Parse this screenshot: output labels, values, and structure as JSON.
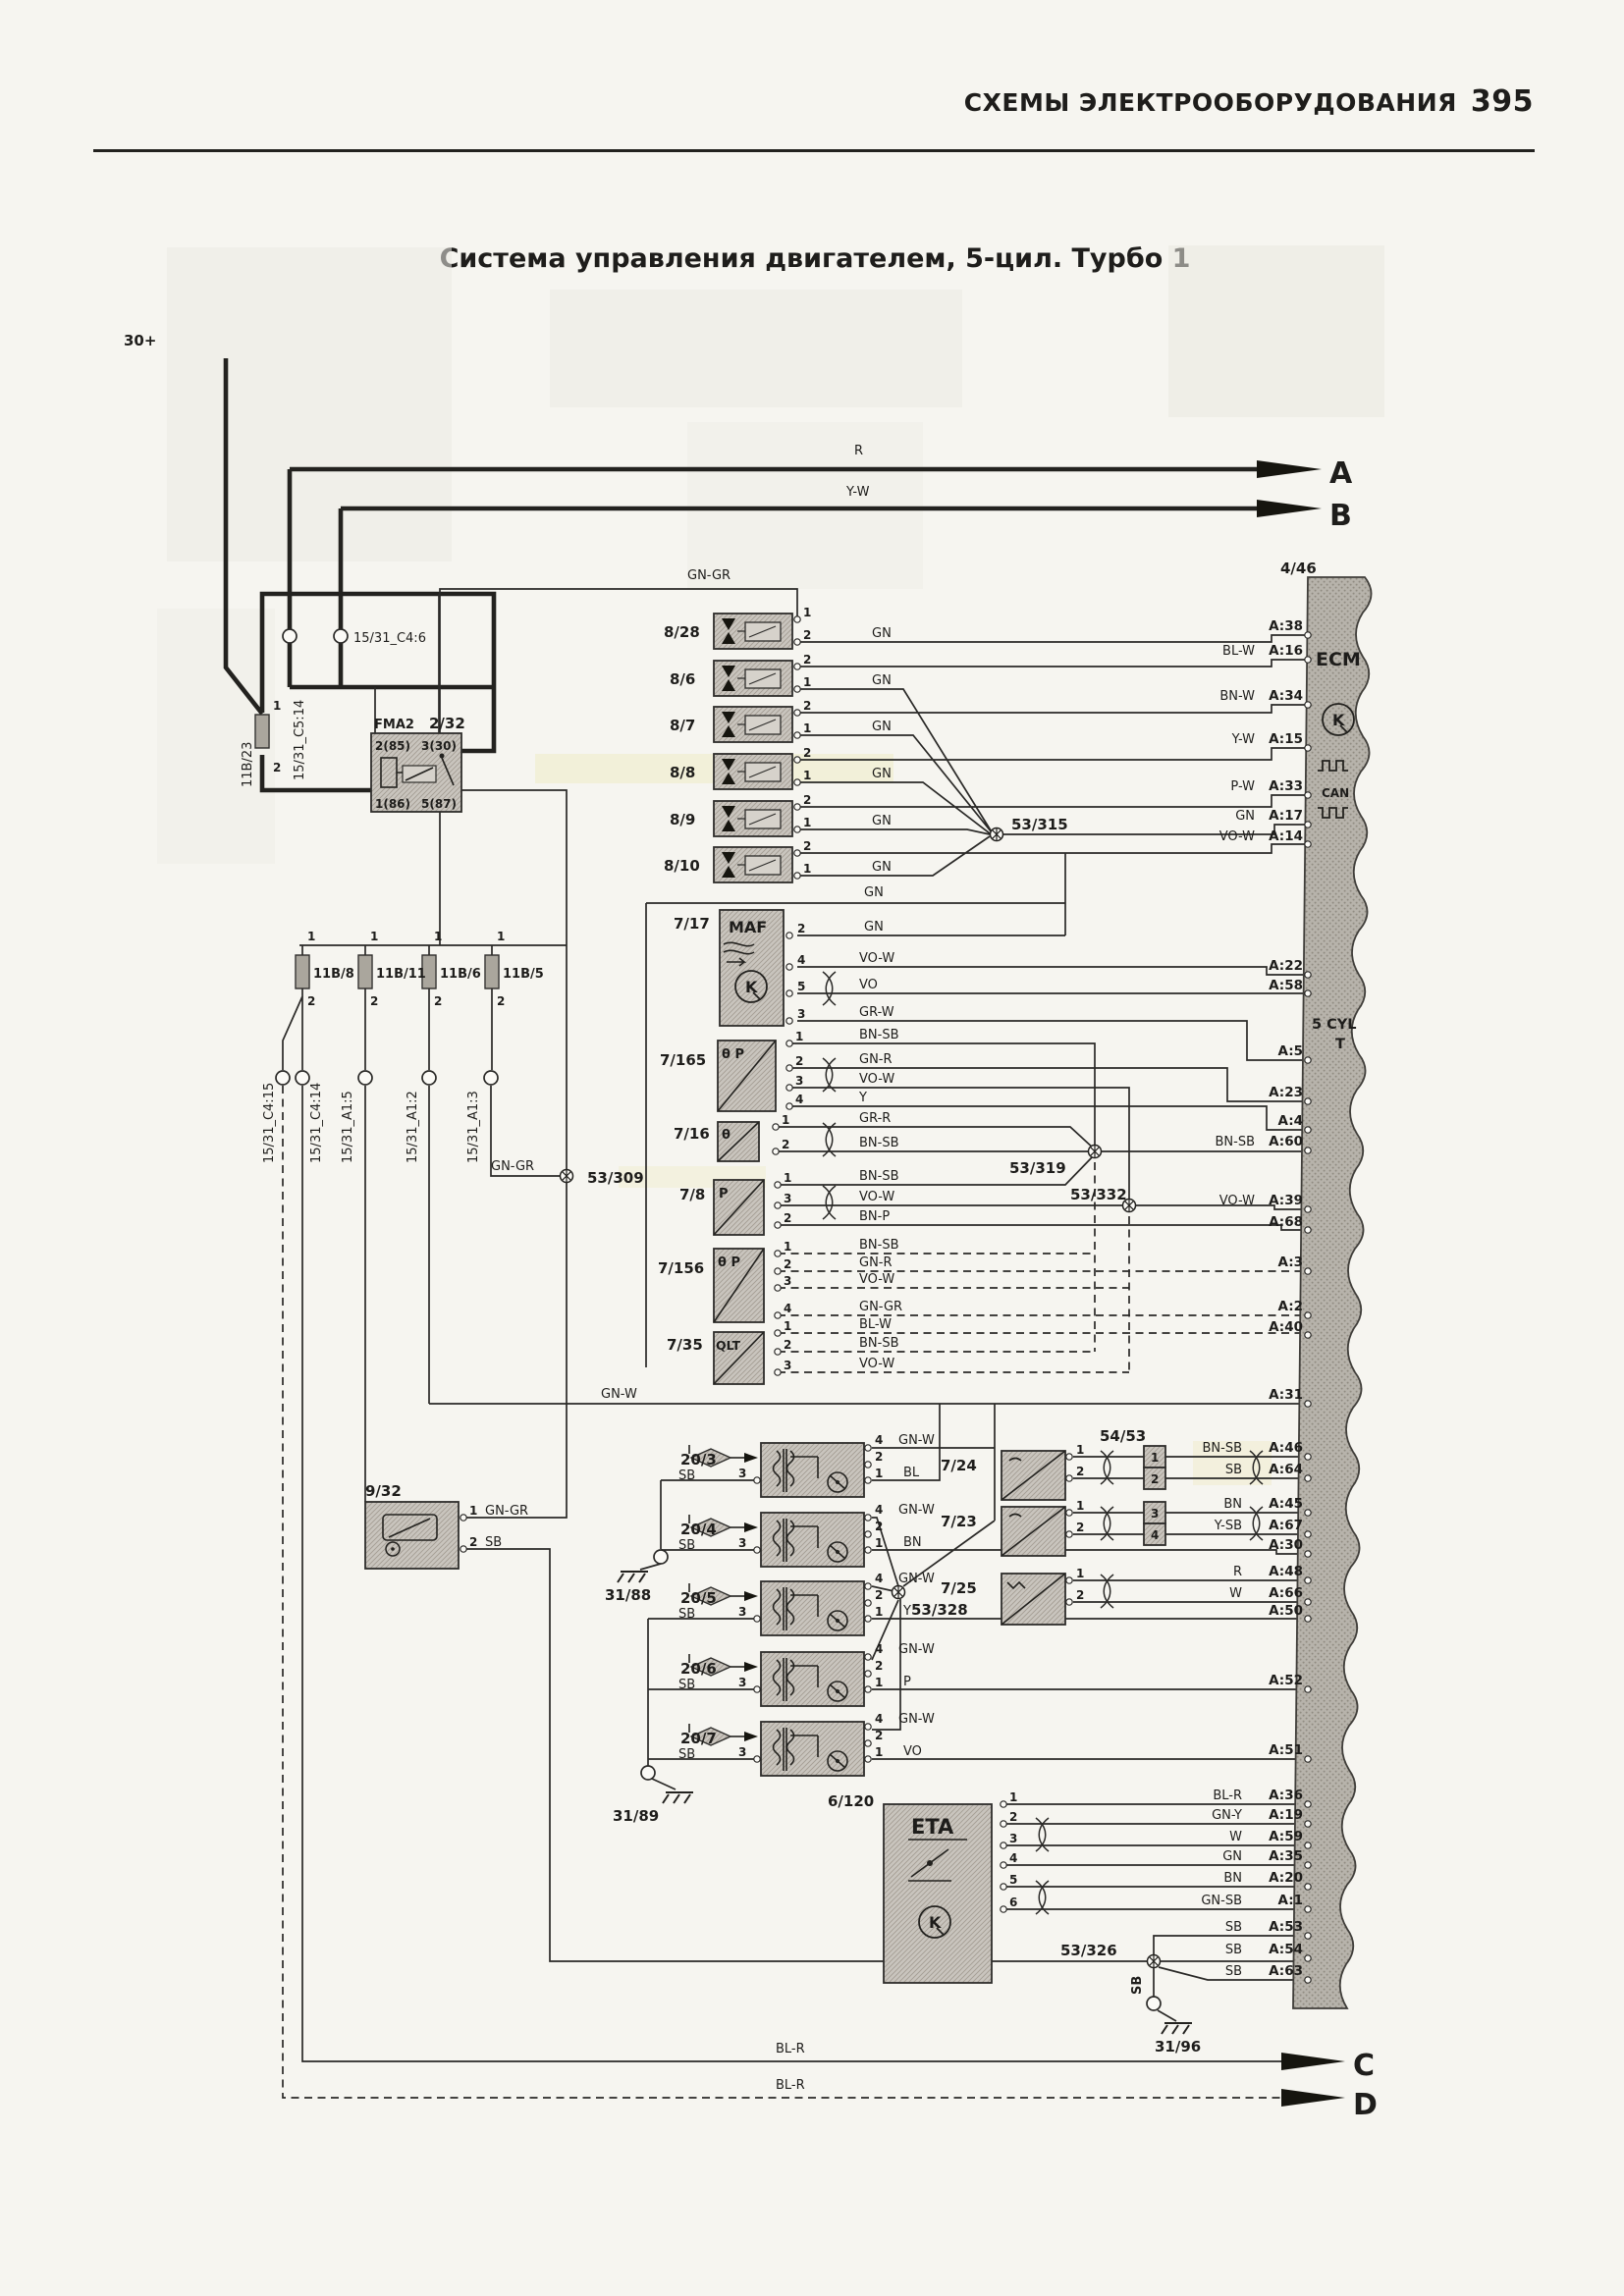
{
  "page": {
    "header": "СХЕМЫ ЭЛЕКТРООБОРУДОВАНИЯ",
    "page_number": "395",
    "title": "Система управления двигателем, 5-цил. Турбо 1"
  },
  "power": {
    "label": "30+"
  },
  "arrows": {
    "a": "A",
    "b": "B",
    "c": "C",
    "d": "D"
  },
  "top_wires": {
    "a": "R",
    "b": "Y-W"
  },
  "bottom_wires": {
    "c": "BL-R",
    "d": "BL-R"
  },
  "relay": {
    "name": "FMA2",
    "id": "2/32",
    "pin_tl": "2(85)",
    "pin_tr": "3(30)",
    "pin_bl": "1(86)",
    "pin_br": "5(87)"
  },
  "fuse_11b23": {
    "id": "11B/23",
    "pin1": "1",
    "pin2": "2"
  },
  "top_connectors": {
    "c514": "15/31_C5:14",
    "c46": "15/31_C4:6"
  },
  "fuse_bus": {
    "pin1": "1",
    "pin2": "2",
    "fuses": [
      {
        "id": "11B/8"
      },
      {
        "id": "11B/11"
      },
      {
        "id": "11B/6"
      },
      {
        "id": "11B/5"
      }
    ]
  },
  "mid_connectors": [
    "15/31_C4:15",
    "15/31_C4:14",
    "15/31_A1:5",
    "15/31_A1:2",
    "15/31_A1:3"
  ],
  "junctions": {
    "j309": "53/309",
    "j315": "53/315",
    "j319": "53/319",
    "j326": "53/326",
    "j328": "53/328",
    "j332": "53/332"
  },
  "grounds": {
    "g88": "31/88",
    "g89": "31/89",
    "g96": "31/96"
  },
  "wire_labels": {
    "gn_gr_top": "GN-GR",
    "gn_gr_309": "GN-GR",
    "gn_w": "GN-W",
    "maf_top_gn": "GN",
    "sb_rot": "SB"
  },
  "injectors": {
    "items": [
      {
        "id": "8/28",
        "pin_top": "1",
        "pin_bot": "2",
        "wire": "GN"
      },
      {
        "id": "8/6",
        "pin_top": "2",
        "pin_bot": "1",
        "wire": "GN"
      },
      {
        "id": "8/7",
        "pin_top": "2",
        "pin_bot": "1",
        "wire": "GN"
      },
      {
        "id": "8/8",
        "pin_top": "2",
        "pin_bot": "1",
        "wire": "GN"
      },
      {
        "id": "8/9",
        "pin_top": "2",
        "pin_bot": "1",
        "wire": "GN"
      },
      {
        "id": "8/10",
        "pin_top": "2",
        "pin_bot": "1",
        "wire": "GN"
      }
    ]
  },
  "maf": {
    "id": "7/17",
    "name": "MAF",
    "pins": [
      {
        "n": "2",
        "wire": "GN"
      },
      {
        "n": "4",
        "wire": "VO-W"
      },
      {
        "n": "5",
        "wire": "VO"
      },
      {
        "n": "3",
        "wire": "GR-W"
      }
    ]
  },
  "s7165": {
    "id": "7/165",
    "sym": "θ P",
    "pins": [
      {
        "n": "1",
        "wire": "BN-SB"
      },
      {
        "n": "2",
        "wire": "GN-R"
      },
      {
        "n": "3",
        "wire": "VO-W"
      },
      {
        "n": "4",
        "wire": "Y"
      }
    ]
  },
  "s716": {
    "id": "7/16",
    "sym": "θ",
    "pins": [
      {
        "n": "1",
        "wire": "GR-R"
      },
      {
        "n": "2",
        "wire": "BN-SB"
      }
    ]
  },
  "s78": {
    "id": "7/8",
    "sym": "P",
    "pins": [
      {
        "n": "1",
        "wire": "BN-SB"
      },
      {
        "n": "3",
        "wire": "VO-W"
      },
      {
        "n": "2",
        "wire": "BN-P"
      }
    ]
  },
  "s7156": {
    "id": "7/156",
    "sym": "θ P",
    "pins": [
      {
        "n": "1",
        "wire": "BN-SB"
      },
      {
        "n": "2",
        "wire": "GN-R"
      },
      {
        "n": "3",
        "wire": "VO-W"
      },
      {
        "n": "4",
        "wire": "GN-GR"
      }
    ]
  },
  "s735": {
    "id": "7/35",
    "sym": "QLT",
    "pins": [
      {
        "n": "1",
        "wire": "BL-W"
      },
      {
        "n": "2",
        "wire": "BN-SB"
      },
      {
        "n": "3",
        "wire": "VO-W"
      }
    ]
  },
  "box932": {
    "id": "9/32",
    "pins": [
      {
        "n": "1",
        "wire": "GN-GR"
      },
      {
        "n": "2",
        "wire": "SB"
      }
    ]
  },
  "coils": {
    "pin_top": "4",
    "pin_mid": "2",
    "pin_bot": "1",
    "pin_left": "3",
    "top_wire": "GN-W",
    "sb": "SB",
    "items": [
      {
        "id": "20/3",
        "wire": "BL"
      },
      {
        "id": "20/4",
        "wire": "BN"
      },
      {
        "id": "20/5",
        "wire": "Y"
      },
      {
        "id": "20/6",
        "wire": "P"
      },
      {
        "id": "20/7",
        "wire": "VO"
      }
    ]
  },
  "s724": {
    "id": "7/24",
    "p1": "1",
    "p2": "2"
  },
  "s723": {
    "id": "7/23",
    "p1": "1",
    "p2": "2"
  },
  "s725": {
    "id": "7/25",
    "p1": "1",
    "p2": "2"
  },
  "conn5453": {
    "id": "54/53",
    "cells": [
      "1",
      "2",
      "3",
      "4"
    ]
  },
  "eta": {
    "id": "6/120",
    "name": "ETA",
    "pins": [
      {
        "n": "1"
      },
      {
        "n": "2"
      },
      {
        "n": "3"
      },
      {
        "n": "4"
      },
      {
        "n": "5"
      },
      {
        "n": "6"
      }
    ]
  },
  "ecm": {
    "conn": "4/46",
    "name": "ECM",
    "can": "CAN",
    "cyl1": "5 CYL",
    "cyl2": "T",
    "pins": [
      {
        "id": "A:38",
        "wire": ""
      },
      {
        "id": "A:16",
        "wire": "BL-W"
      },
      {
        "id": "A:34",
        "wire": "BN-W"
      },
      {
        "id": "A:15",
        "wire": "Y-W"
      },
      {
        "id": "A:33",
        "wire": "P-W"
      },
      {
        "id": "A:17",
        "wire": "GN"
      },
      {
        "id": "A:14",
        "wire": "VO-W"
      },
      {
        "id": "A:22",
        "wire": ""
      },
      {
        "id": "A:58",
        "wire": ""
      },
      {
        "id": "A:5",
        "wire": ""
      },
      {
        "id": "A:23",
        "wire": ""
      },
      {
        "id": "A:4",
        "wire": ""
      },
      {
        "id": "A:60",
        "wire": "BN-SB"
      },
      {
        "id": "A:39",
        "wire": "VO-W"
      },
      {
        "id": "A:68",
        "wire": ""
      },
      {
        "id": "A:3",
        "wire": ""
      },
      {
        "id": "A:2",
        "wire": ""
      },
      {
        "id": "A:40",
        "wire": ""
      },
      {
        "id": "A:31",
        "wire": ""
      },
      {
        "id": "A:46",
        "wire": "BN-SB"
      },
      {
        "id": "A:64",
        "wire": "SB"
      },
      {
        "id": "A:45",
        "wire": "BN"
      },
      {
        "id": "A:67",
        "wire": "Y-SB"
      },
      {
        "id": "A:30",
        "wire": ""
      },
      {
        "id": "A:48",
        "wire": "R"
      },
      {
        "id": "A:66",
        "wire": "W"
      },
      {
        "id": "A:50",
        "wire": ""
      },
      {
        "id": "A:52",
        "wire": ""
      },
      {
        "id": "A:51",
        "wire": ""
      },
      {
        "id": "A:36",
        "wire": "BL-R"
      },
      {
        "id": "A:19",
        "wire": "GN-Y"
      },
      {
        "id": "A:59",
        "wire": "W"
      },
      {
        "id": "A:35",
        "wire": "GN"
      },
      {
        "id": "A:20",
        "wire": "BN"
      },
      {
        "id": "A:1",
        "wire": "GN-SB"
      },
      {
        "id": "A:53",
        "wire": "SB"
      },
      {
        "id": "A:54",
        "wire": "SB"
      },
      {
        "id": "A:63",
        "wire": "SB"
      }
    ]
  }
}
